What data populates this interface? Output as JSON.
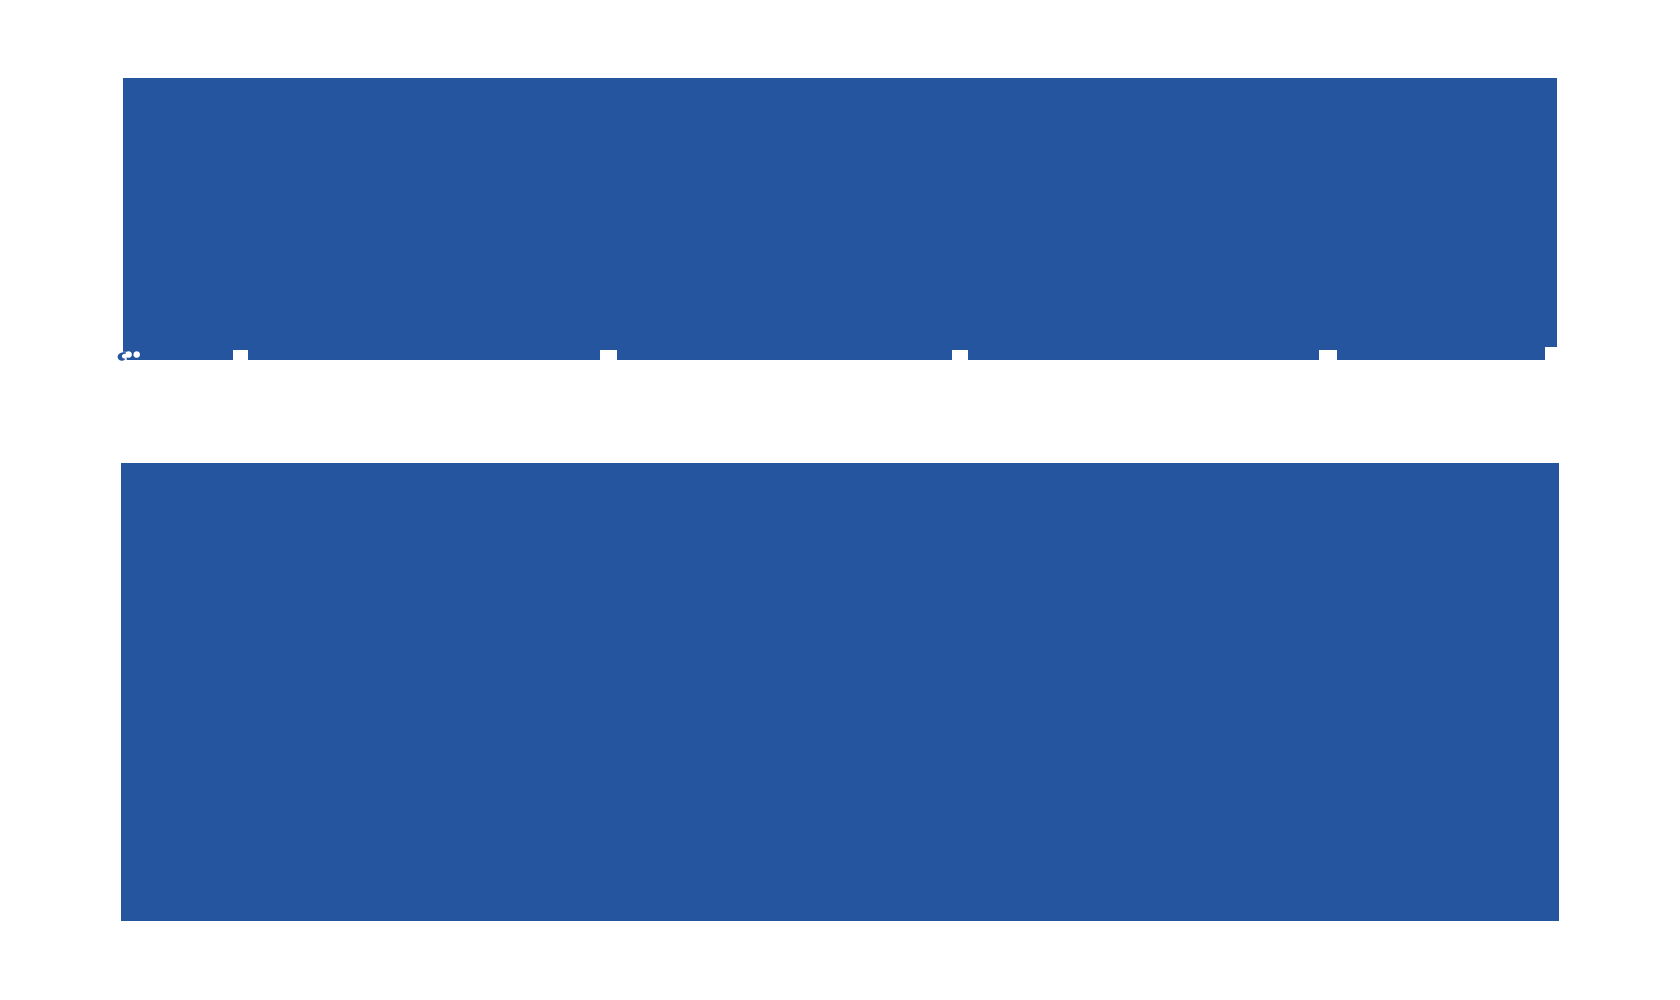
{
  "canvas": {
    "width_px": 1680,
    "height_px": 1000,
    "background_color": "#FFFFFF"
  },
  "colors": {
    "block_blue": "#25559E",
    "background_white": "#FFFFFF"
  },
  "blocks": {
    "top": {
      "text": ""
    },
    "bottom": {
      "text": ""
    }
  },
  "icons": {
    "clipped_glyph": "clipped-glyph-icon"
  }
}
